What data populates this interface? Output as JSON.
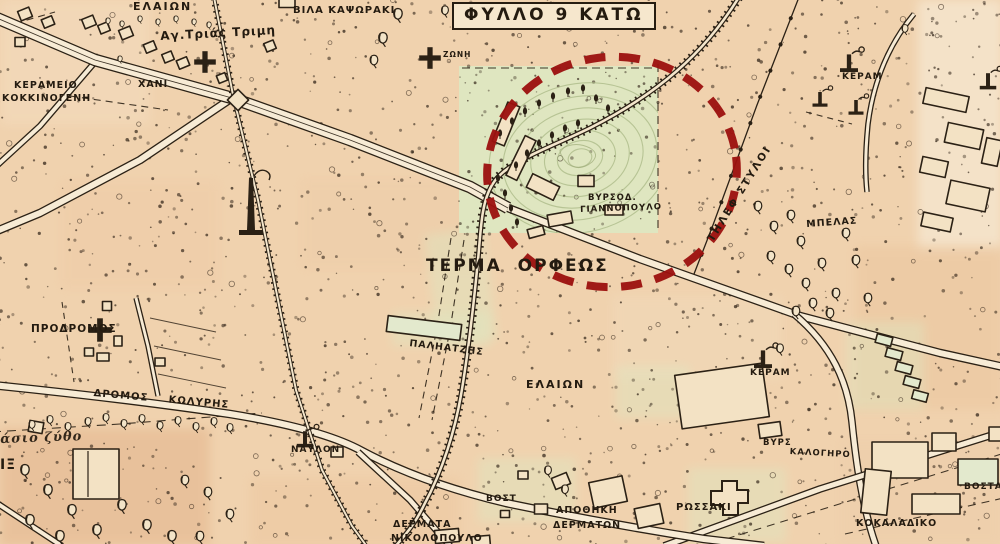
{
  "title": "ΦΥΛΛΟ 9 ΚΑΤΩ",
  "labels": {
    "elaion_top": "ΕΛΑΙΩΝ",
    "agia_trias": "Αγ.Τριάς Τριμη",
    "kerameio_line1": "ΚΕΡΑΜΕΙΟ",
    "kerameio_line2": "ΚΟΚΚΙΝΟΓΕΝΗ",
    "xani": "ΧΑΝΙ",
    "vila_kapsoraki": "ΒΙΛΑ ΚΑΨΩΡΑΚΙ",
    "zoni": "ΖΩΝΗ",
    "keram_top_right": "ΚΕΡΑΜ",
    "byrsod": "ΒΥΡΣΟΔ.",
    "giannopoulo": "ΓΙΑΝΝΟΠΟΥΛΟ",
    "terma_orfeos": "ΤΕΡΜΑ ΟΡΦΕΩΣ",
    "tilef_styloi": "ΤΗΛΕΦ ΣΤΥΛΟΙ",
    "mpelas": "ΜΠΕΛΑΣ",
    "prodromos": "ΠΡΟΔΡΟΜΟΣ",
    "dromos_koliris": "ΔΡΟΜΟΣ ΚΩΛΥΡΗΣ",
    "paliatzis": "ΠΑΛΗΑΤΖΗΣ",
    "elaion_center": "ΕΛΑΙΩΝ",
    "keram_middle": "ΚΕΡΑΜ",
    "asio_zytho": "άσιο ζύθο",
    "fix_partial": "ΙΞ",
    "naylon": "ΝΑΥΛΟΝ",
    "vost": "ΒΟΣΤ",
    "apothiki": "ΑΠΟΘΗΚΗ",
    "dermaton": "ΔΕΡΜΑΤΩΝ",
    "dermata": "ΔΕΡΜΑΤΑ",
    "nikolopoulo": "ΝΙΚΟΛΟΠΟΥΛΟ",
    "rossaki": "ΡΩΣΣΑΚΙ",
    "byrs": "ΒΥΡΣ",
    "kalogiro": "ΚΑΛΟΓΗΡΟ",
    "kokaladiko": "ΚΟΚΑΛΑΔΙΚΟ",
    "vostan": "ΒΟΣΤΑΝ"
  },
  "colors": {
    "paper": "#f0d2ae",
    "ink": "#2b2115",
    "zone_green": "#dde8c2",
    "road_fill": "#f7ebd5",
    "highlight_red": "#9c1210",
    "contour_green": "#a9b885"
  }
}
